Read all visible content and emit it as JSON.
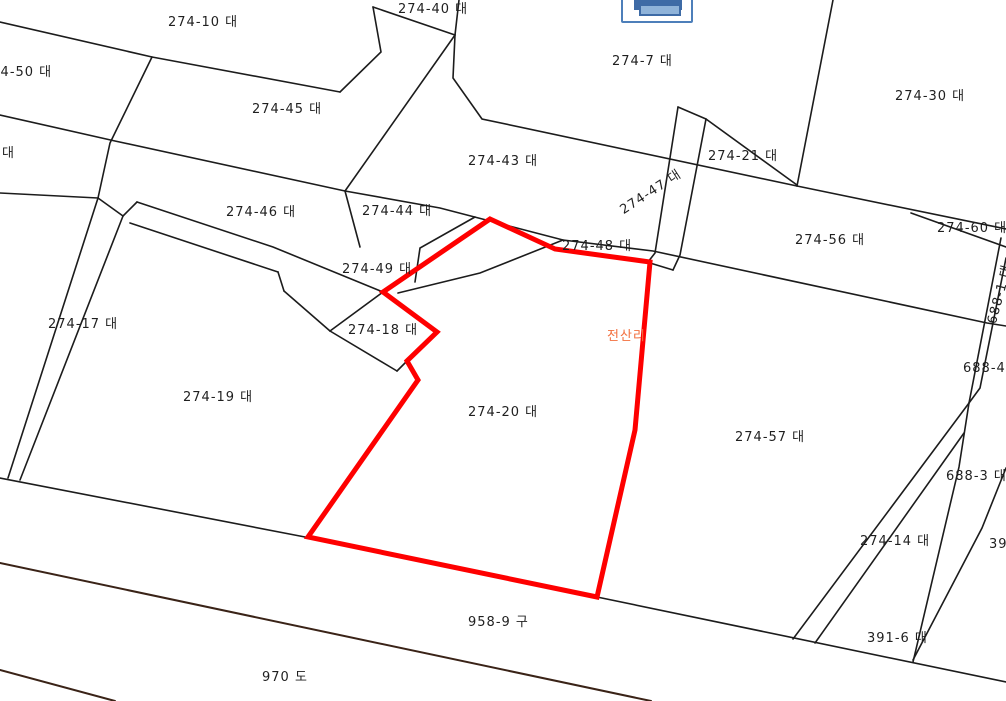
{
  "window": {
    "title": "cadastral-map-view",
    "width": 1006,
    "height": 701,
    "background": "#ffffff"
  },
  "toolbar": {
    "print_button": {
      "icon": "printer-icon",
      "border_color": "#4d7fba",
      "icon_color": "#3e6ba6",
      "tray_color": "#8fb3d9"
    }
  },
  "map": {
    "boundary_line_color": "#1c1c1c",
    "road_line_color": "#3a2317",
    "highlight": {
      "parcel": "274-20",
      "color": "#fe0000"
    },
    "village_label": {
      "text": "전산리",
      "color": "#f2703f"
    },
    "labels": [
      {
        "id": "274-50",
        "text": "274-50 대",
        "x": -18,
        "y": 66
      },
      {
        "id": "274-10",
        "text": "274-10 대",
        "x": 168,
        "y": 16
      },
      {
        "id": "274-40",
        "text": "274-40 대",
        "x": 398,
        "y": 3
      },
      {
        "id": "274-7",
        "text": "274-7 대",
        "x": 612,
        "y": 55
      },
      {
        "id": "274-30",
        "text": "274-30 대",
        "x": 895,
        "y": 90
      },
      {
        "id": "fragment-dae",
        "text": "대",
        "x": 2,
        "y": 147
      },
      {
        "id": "274-45",
        "text": "274-45 대",
        "x": 252,
        "y": 103
      },
      {
        "id": "274-43",
        "text": "274-43 대",
        "x": 468,
        "y": 155
      },
      {
        "id": "274-21",
        "text": "274-21 대",
        "x": 708,
        "y": 150
      },
      {
        "id": "274-47",
        "text": "274-47 대",
        "x": 618,
        "y": 206,
        "rot": -33
      },
      {
        "id": "274-60",
        "text": "274-60 대",
        "x": 937,
        "y": 222
      },
      {
        "id": "274-56",
        "text": "274-56 대",
        "x": 795,
        "y": 234
      },
      {
        "id": "274-44",
        "text": "274-44 대",
        "x": 362,
        "y": 205
      },
      {
        "id": "274-46",
        "text": "274-46 대",
        "x": 226,
        "y": 206
      },
      {
        "id": "274-48",
        "text": "274-48 대",
        "x": 562,
        "y": 240
      },
      {
        "id": "274-49",
        "text": "274-49 대",
        "x": 342,
        "y": 263
      },
      {
        "id": "688-1",
        "text": "688-1 대",
        "x": 986,
        "y": 322,
        "rot": -75
      },
      {
        "id": "274-17",
        "text": "274-17 대",
        "x": 48,
        "y": 318
      },
      {
        "id": "274-18",
        "text": "274-18 대",
        "x": 348,
        "y": 324
      },
      {
        "id": "village",
        "text": "전산리",
        "x": 607,
        "y": 330,
        "color": "#f2703f"
      },
      {
        "id": "688-4",
        "text": "688-4",
        "x": 963,
        "y": 362
      },
      {
        "id": "274-19",
        "text": "274-19 대",
        "x": 183,
        "y": 391
      },
      {
        "id": "274-20",
        "text": "274-20 대",
        "x": 468,
        "y": 406
      },
      {
        "id": "274-57",
        "text": "274-57 대",
        "x": 735,
        "y": 431
      },
      {
        "id": "688-3",
        "text": "688-3 대",
        "x": 946,
        "y": 470
      },
      {
        "id": "274-14",
        "text": "274-14 대",
        "x": 860,
        "y": 535
      },
      {
        "id": "fragment-39",
        "text": "39",
        "x": 989,
        "y": 538
      },
      {
        "id": "391-6",
        "text": "391-6 대",
        "x": 867,
        "y": 632
      },
      {
        "id": "958-9",
        "text": "958-9 구",
        "x": 468,
        "y": 616
      },
      {
        "id": "970",
        "text": "970 도",
        "x": 262,
        "y": 671
      }
    ]
  }
}
